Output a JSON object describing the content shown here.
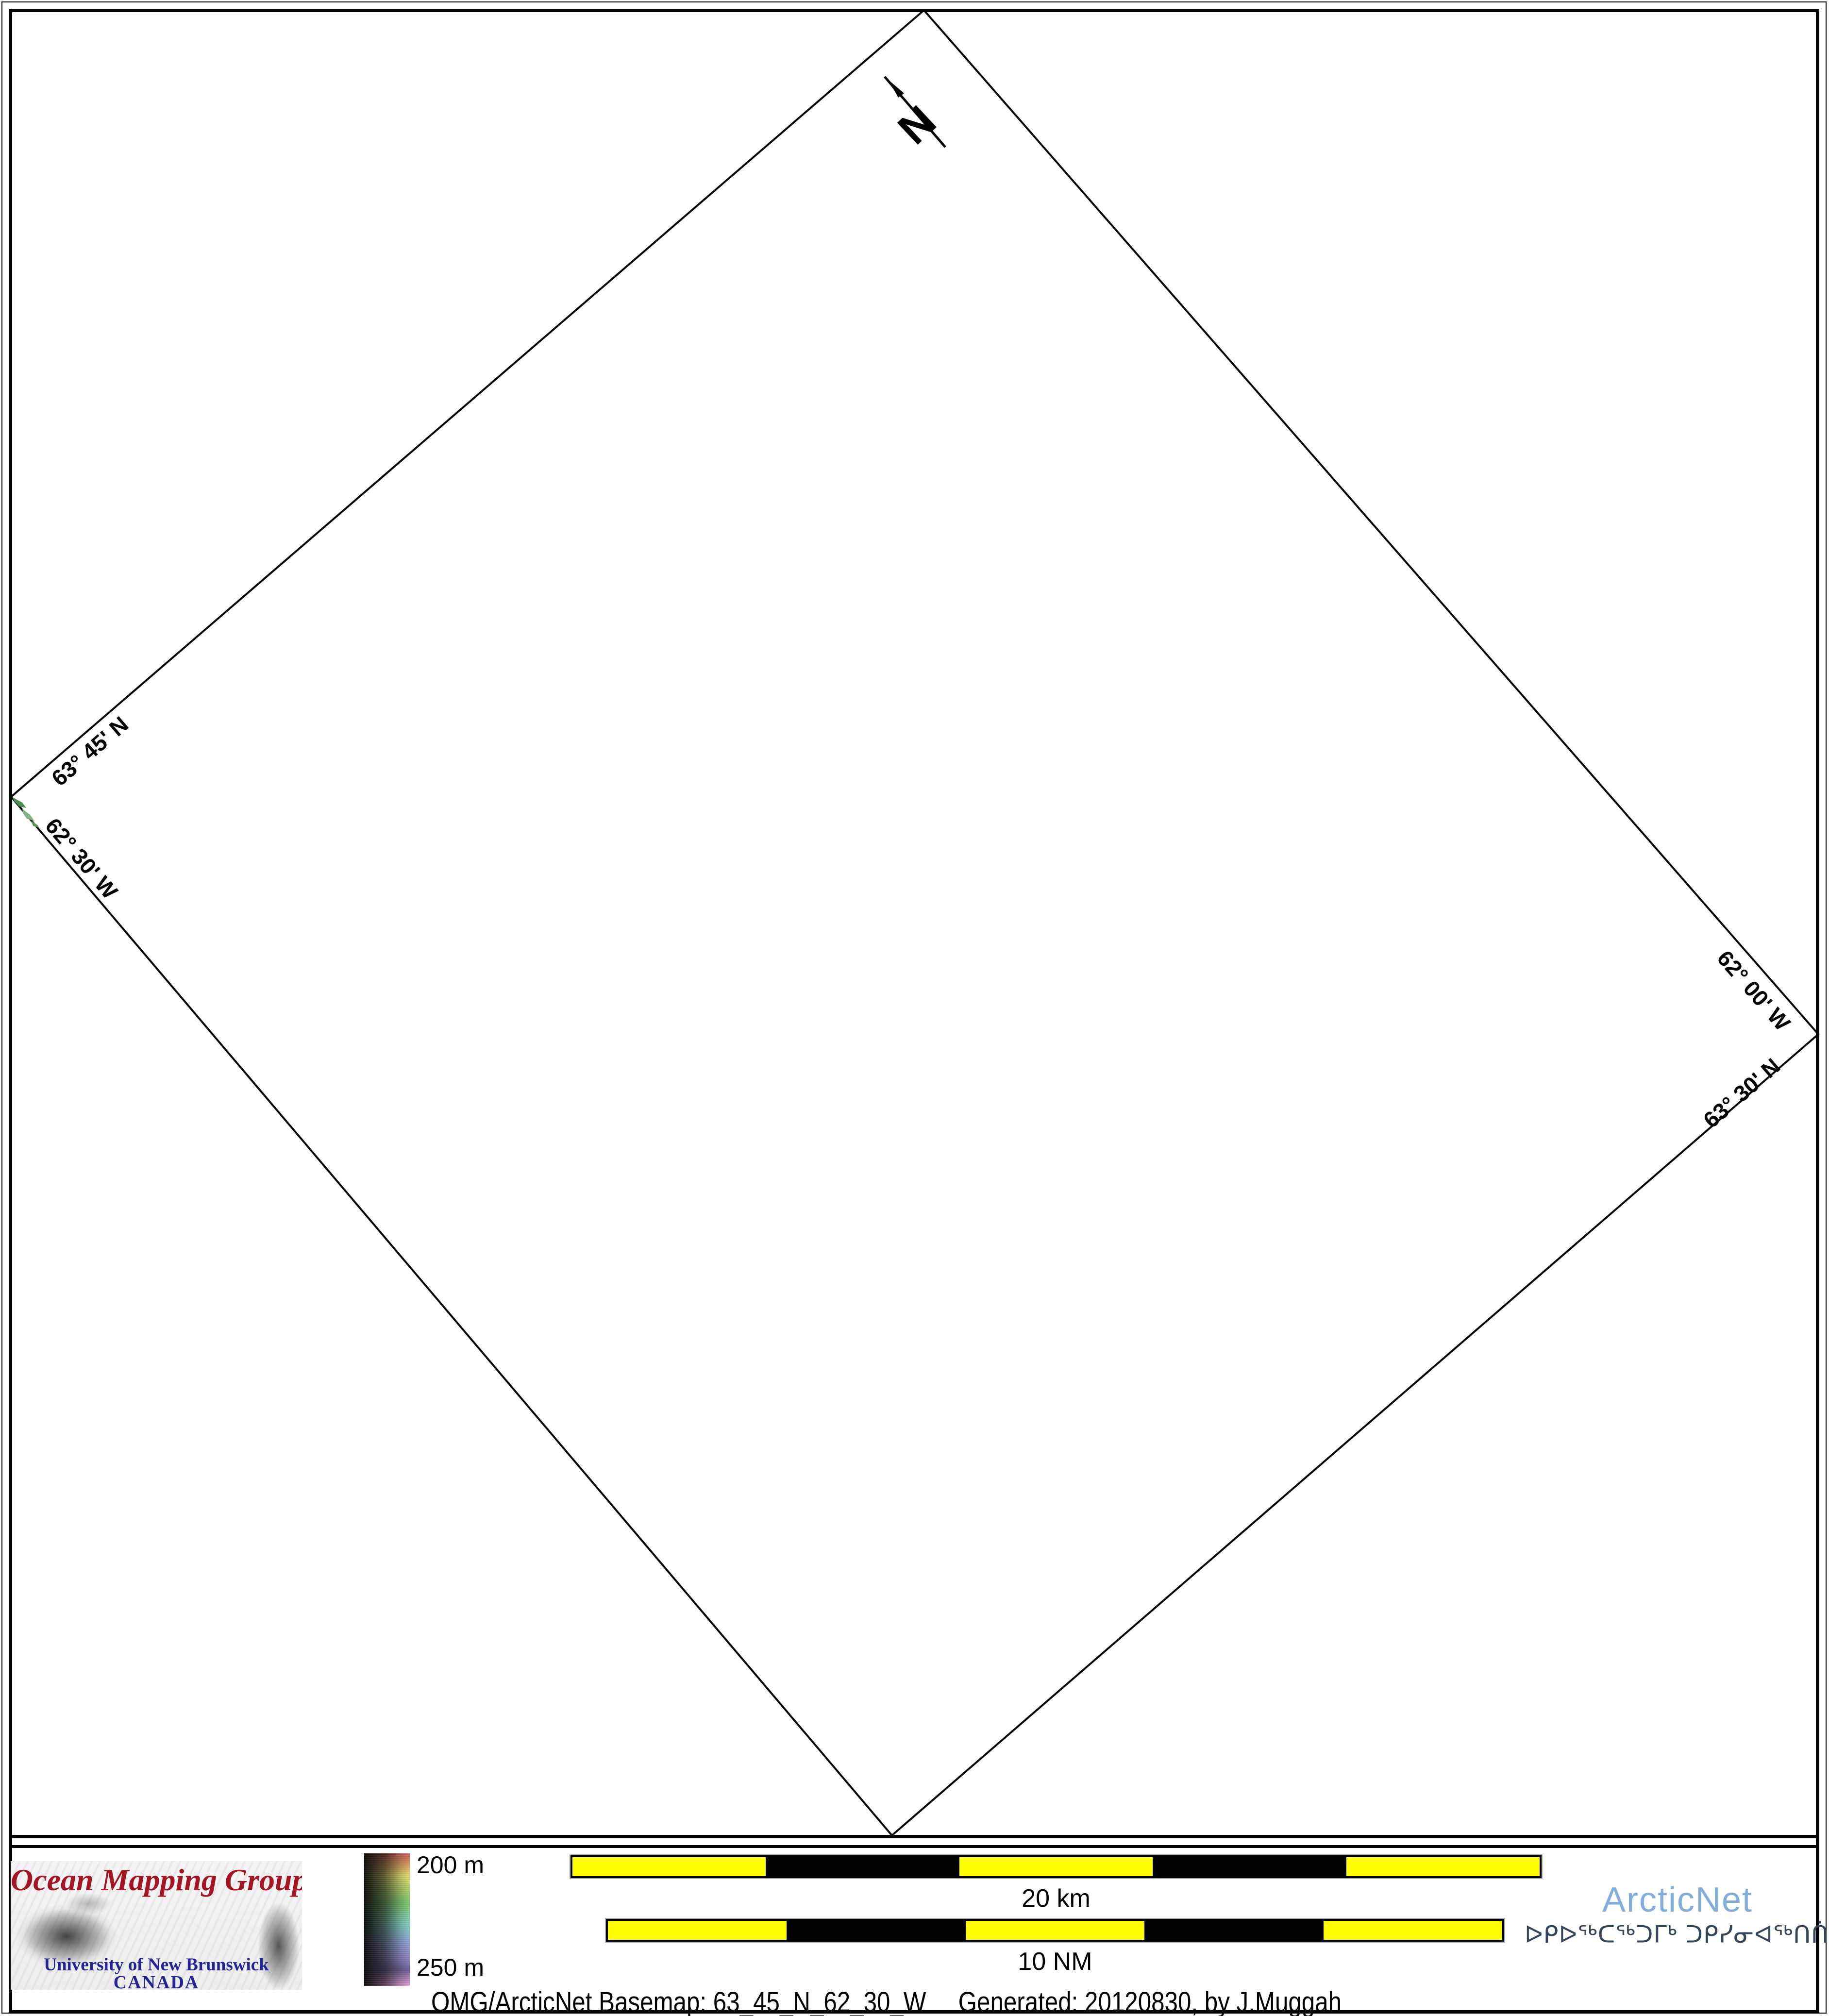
{
  "map": {
    "compass": {
      "label": "N"
    },
    "edge_labels": [
      {
        "id": "lat-top-left",
        "text": "63° 45' N"
      },
      {
        "id": "lon-bottom-left",
        "text": "62° 30' W"
      },
      {
        "id": "lon-top-right",
        "text": "62° 00' W"
      },
      {
        "id": "lat-bottom-right",
        "text": "63° 30' N"
      }
    ],
    "land_color": "#5d9a60"
  },
  "footer": {
    "omg": {
      "title": "Ocean Mapping Group",
      "line1": "University of New Brunswick",
      "line2": "CANADA",
      "title_color": "#a31523",
      "text_color": "#232399"
    },
    "colorbar": {
      "top_label": "200 m",
      "bottom_label": "250 m"
    },
    "scalebar_km": {
      "label": "20 km",
      "segments": 5,
      "segment_colors": [
        "#ffff00",
        "#000000"
      ]
    },
    "scalebar_nm": {
      "label": "10 NM",
      "segments": 5,
      "segment_colors": [
        "#ffff00",
        "#000000"
      ]
    },
    "arcticnet": {
      "name": "ArcticNet",
      "inuktitut": "ᐅᑭᐅᖅᑕᖅᑐᒥᒃ ᑐᑭᓯᓂᐊᖅᑎᑏᑦ",
      "name_color": "#82aedd",
      "inuktitut_color": "#33465c"
    },
    "caption": {
      "left": "OMG/ArcticNet Basemap: 63_45_N_62_30_W",
      "right": "Generated: 20120830, by J.Muggah"
    }
  }
}
